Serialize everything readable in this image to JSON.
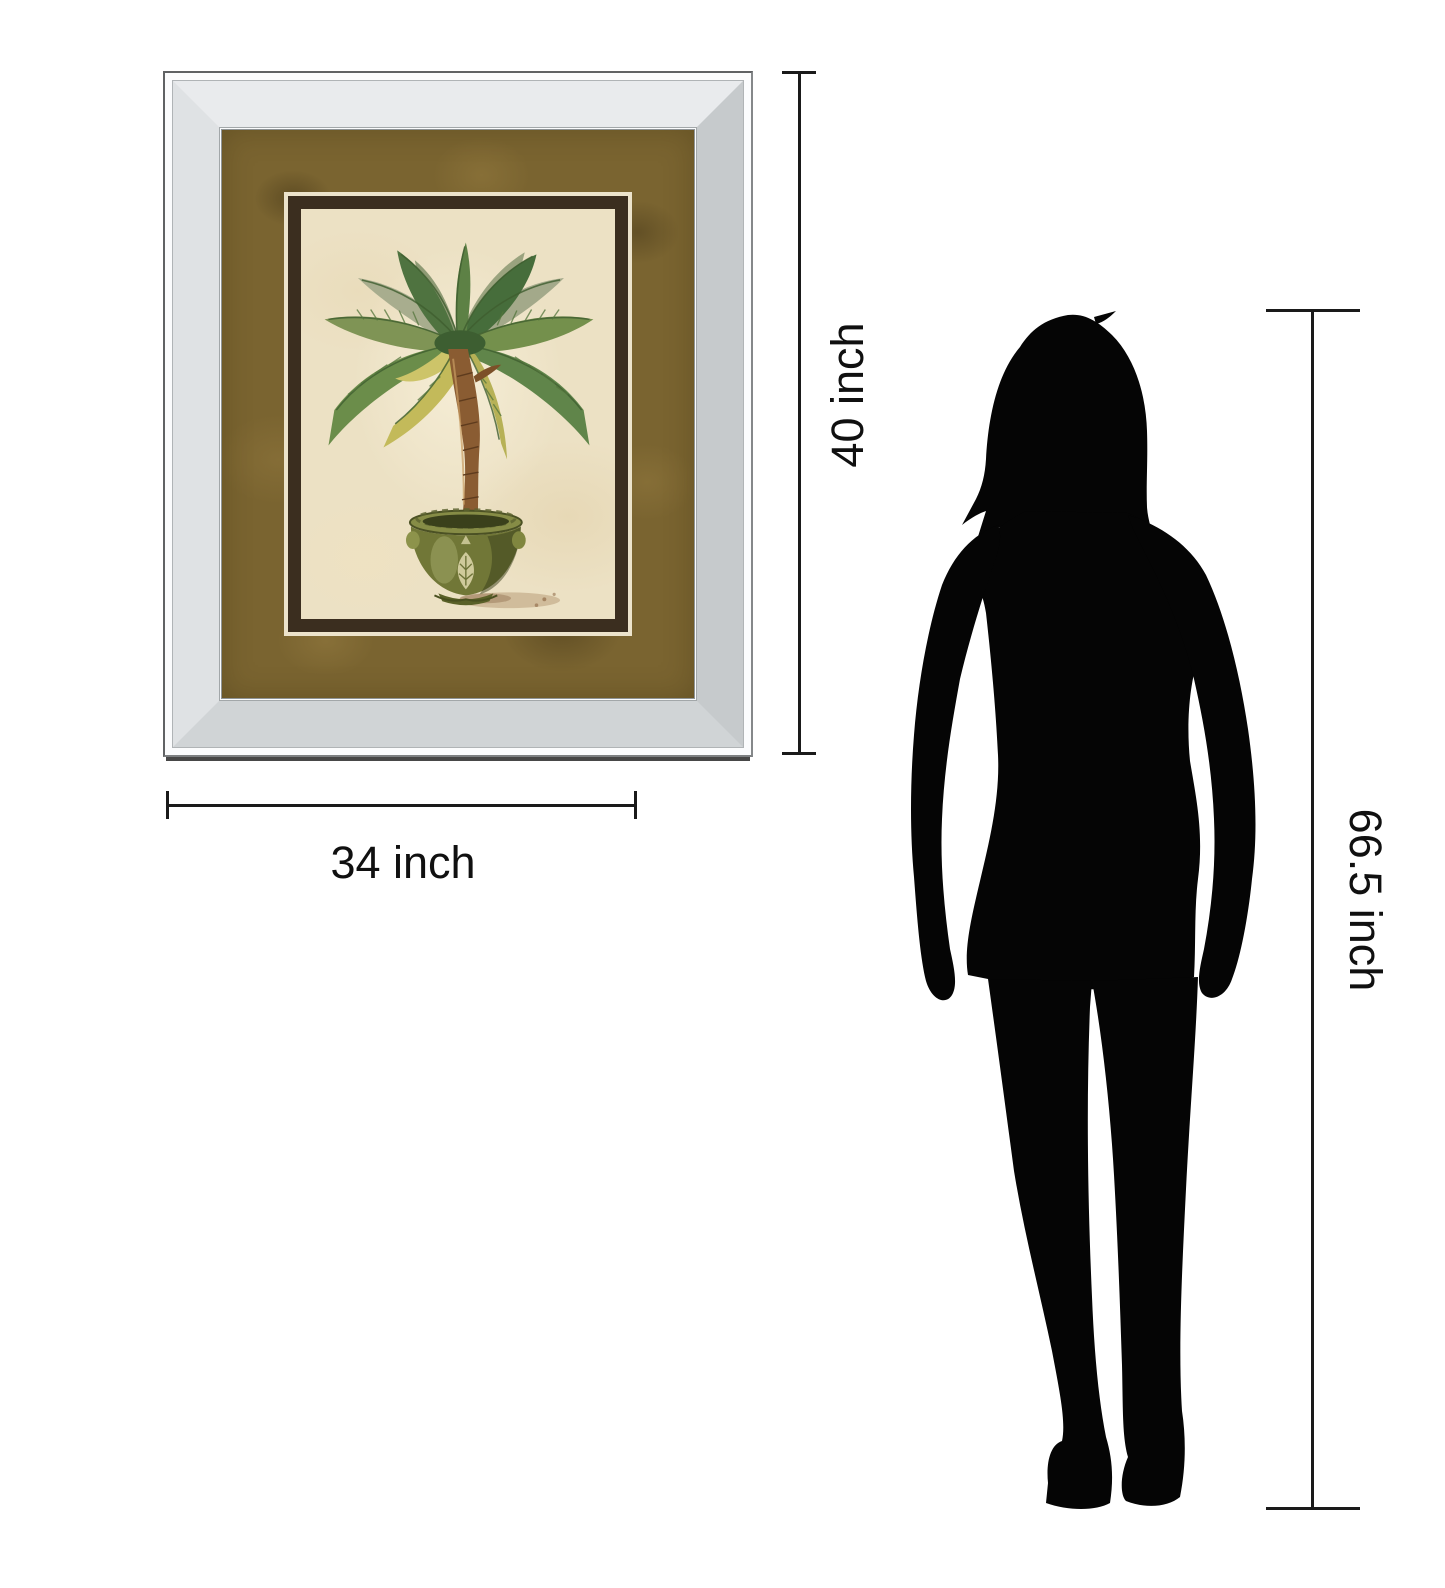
{
  "diagram": {
    "description": "Product size comparison of a mirror-framed palm tree wall art next to a standing woman silhouette",
    "background_color": "#ffffff",
    "line_color": "#1a1a1a"
  },
  "artwork": {
    "name": "Palm tree print in beveled mirror frame",
    "frame_finish": "silver beveled mirror",
    "mat_color": "#7a6430",
    "inner_border_color": "#3b2e1f",
    "print_background_color": "#ece1c4",
    "subject": "Potted palm tree in a green decorative planter"
  },
  "measurements": {
    "artwork_height_label": "40 inch",
    "artwork_width_label": "34 inch",
    "person_height_label": "66.5 inch"
  },
  "person": {
    "description": "Standing woman silhouette",
    "color": "#000000"
  }
}
